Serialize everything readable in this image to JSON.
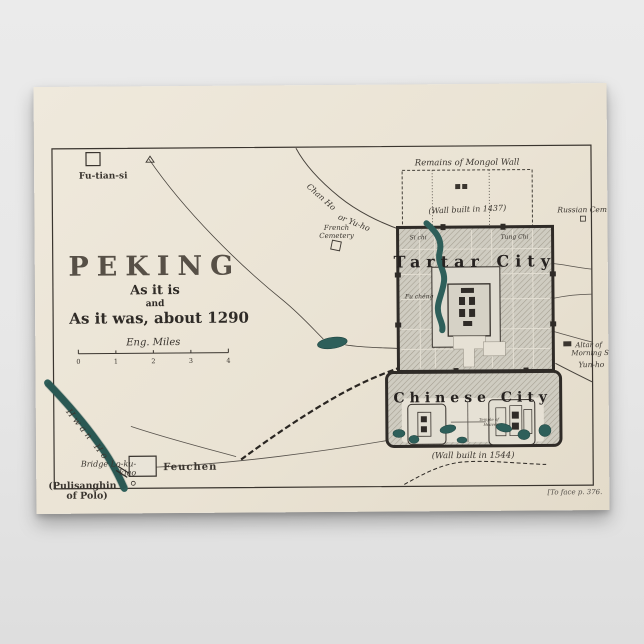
{
  "scene": {
    "background_color": "#e7e7e7",
    "poster_paper_color": "#eae3d4"
  },
  "map": {
    "colors": {
      "ink": "#3a352f",
      "water": "#2e5f5a",
      "city_hatch": "#cfccc1",
      "frame": "#3a352f"
    },
    "title": "PEKING",
    "subtitle_line1": "As it is",
    "subtitle_line2": "and",
    "subtitle_line3": "As it was, about 1290",
    "scale": {
      "label": "Eng. Miles",
      "ticks": [
        "0",
        "1",
        "2",
        "3",
        "4"
      ]
    },
    "footnote": "[To face p. 376.",
    "labels": {
      "fu_tian_si": "Fu-tian-si",
      "chan_ho_a": "Chan Ho",
      "chan_ho_b": "or Yu-ho",
      "french_cemetery_1": "French",
      "french_cemetery_2": "Cemetery",
      "remains_mongol_wall": "Remains of Mongol Wall",
      "wall_built_north": "(Wall built in 1437)",
      "russian_cem": "Russian Cem.",
      "tartar_city": "Tartar City",
      "si_chi": "Si chi",
      "tung_chi": "Tung Chi",
      "fu_cheng": "Fu chéng",
      "altar_line1": "Altar of",
      "altar_line2": "Morning Sun",
      "yun_ho": "Yun-ho",
      "chinese_city": "Chinese City",
      "temple_heaven_1": "Temple of",
      "temple_heaven_2": "Heaven",
      "wall_built_south": "(Wall built in 1544)",
      "hwan_ho": "Hwan Ho",
      "bridge_line1": "Bridge Lo-ku-",
      "bridge_line2": "kiao",
      "pulisanghin_line1": "(Pulisanghin",
      "pulisanghin_line2": "of Polo)",
      "feuchen": "Feuchen"
    }
  }
}
